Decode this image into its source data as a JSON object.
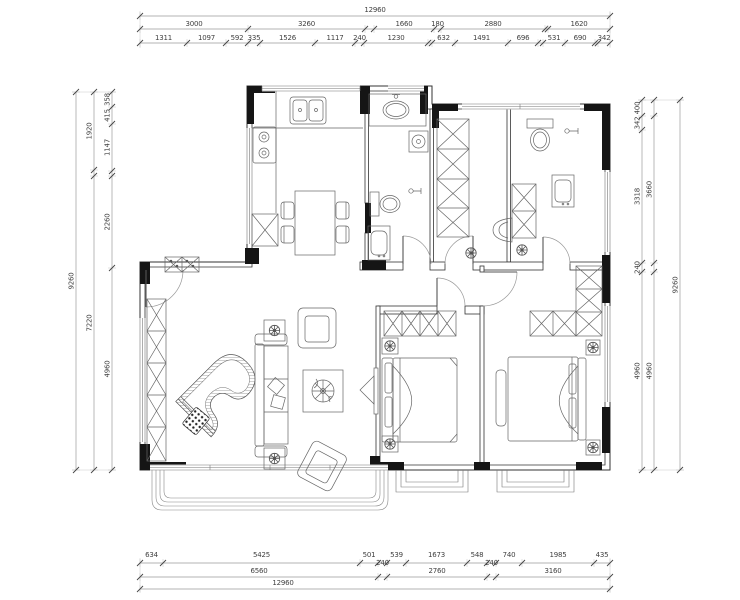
{
  "canvas": {
    "width": 740,
    "height": 600
  },
  "colors": {
    "background": "#ffffff",
    "wall_line": "#333333",
    "wall_fill": "#151515",
    "furniture_line": "#666666",
    "dim_line": "#9a9a9a",
    "dim_tick": "#444444",
    "dim_text": "#3f3f3f"
  },
  "dimensions": {
    "top": [
      {
        "y": 16,
        "ly": 12,
        "b": [
          140,
          610
        ],
        "labels": [
          "12960"
        ]
      },
      {
        "y": 29,
        "ly": 26,
        "b": [
          140,
          248,
          365,
          374,
          434,
          441,
          545,
          548,
          610
        ],
        "labels": [
          "3000",
          "3260",
          "",
          "1660",
          "180",
          "2880",
          "",
          "1620"
        ]
      },
      {
        "y": 43,
        "ly": 40,
        "b": [
          140,
          187,
          226,
          248,
          260,
          315,
          355,
          364,
          428,
          432,
          455,
          508,
          538,
          543,
          565,
          595,
          598,
          610
        ],
        "labels": [
          "1311",
          "1097",
          "592",
          "335",
          "1526",
          "1117",
          "240",
          "1230",
          "",
          "632",
          "1491",
          "696",
          "",
          "531",
          "690",
          "",
          "342"
        ]
      }
    ],
    "bottom": [
      {
        "y": 563,
        "ly": 557,
        "dy": {
          "3": 8,
          "7": 8
        },
        "b": [
          140,
          163,
          360,
          378,
          387,
          406,
          467,
          487,
          496,
          522,
          594,
          610
        ],
        "labels": [
          "634",
          "5425",
          "501",
          "240",
          "539",
          "1673",
          "548",
          "240",
          "740",
          "1985",
          "435"
        ]
      },
      {
        "y": 577,
        "ly": 573,
        "b": [
          140,
          378,
          387,
          487,
          496,
          610
        ],
        "labels": [
          "6560",
          "",
          "2760",
          "",
          "3160"
        ]
      },
      {
        "y": 589,
        "ly": 585,
        "lx": {
          "0": 283
        },
        "b": [
          140,
          610
        ],
        "labels": [
          "12960"
        ]
      }
    ],
    "left": [
      {
        "x": 76,
        "b": [
          92,
          470
        ],
        "labels": [
          "9260"
        ]
      },
      {
        "x": 94,
        "b": [
          92,
          170,
          176,
          470
        ],
        "labels": [
          "1920",
          "",
          "7220"
        ]
      },
      {
        "x": 112,
        "b": [
          92,
          107,
          124,
          171,
          176,
          268,
          470
        ],
        "labels": [
          "358",
          "415",
          "1147",
          "",
          "2260",
          "4960"
        ]
      }
    ],
    "right": [
      {
        "x": 642,
        "b": [
          100,
          116,
          130,
          263,
          272,
          470
        ],
        "labels": [
          "400",
          "342",
          "3318",
          "240",
          "4960"
        ]
      },
      {
        "x": 654,
        "b": [
          100,
          116,
          263,
          272,
          470
        ],
        "labels": [
          "",
          "3660",
          "",
          "4960"
        ]
      },
      {
        "x": 680,
        "b": [
          100,
          470
        ],
        "labels": [
          "9260"
        ]
      }
    ]
  }
}
